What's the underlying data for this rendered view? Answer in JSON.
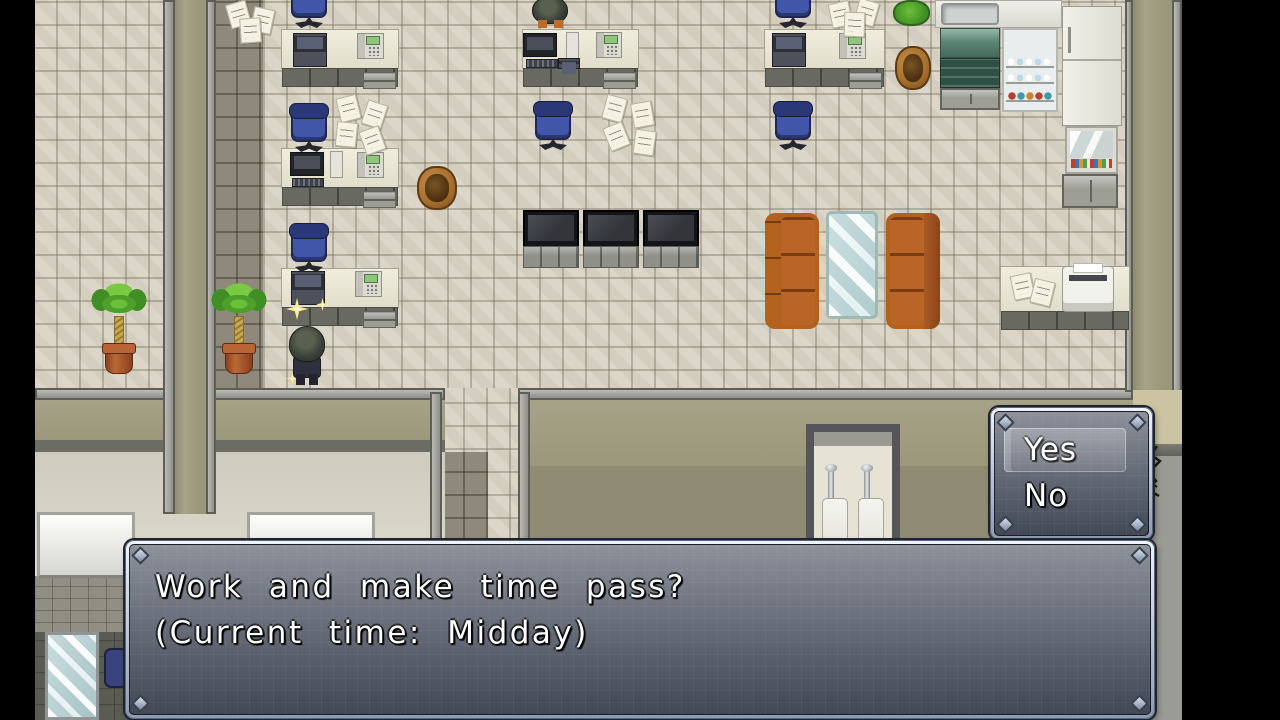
{
  "message_window": {
    "lines": [
      "Work and make time pass?",
      "(Current time: Midday)"
    ]
  },
  "choice_window": {
    "options": [
      {
        "label": "Yes",
        "selected": true
      },
      {
        "label": "No",
        "selected": false
      }
    ],
    "selected_index": 0
  },
  "palette": {
    "window_frame": "#c6d0df",
    "window_background": "rgba(40,44,54,0.62)",
    "text_color": "#ffffff",
    "floor_tile": "#d9d3c4",
    "wall_olive": "#a19d80",
    "couch_orange": "#b2611f",
    "chair_blue": "#4156a8",
    "glass_teal": "#cfe8e8",
    "sparkle_yellow": "#ffe98e"
  }
}
